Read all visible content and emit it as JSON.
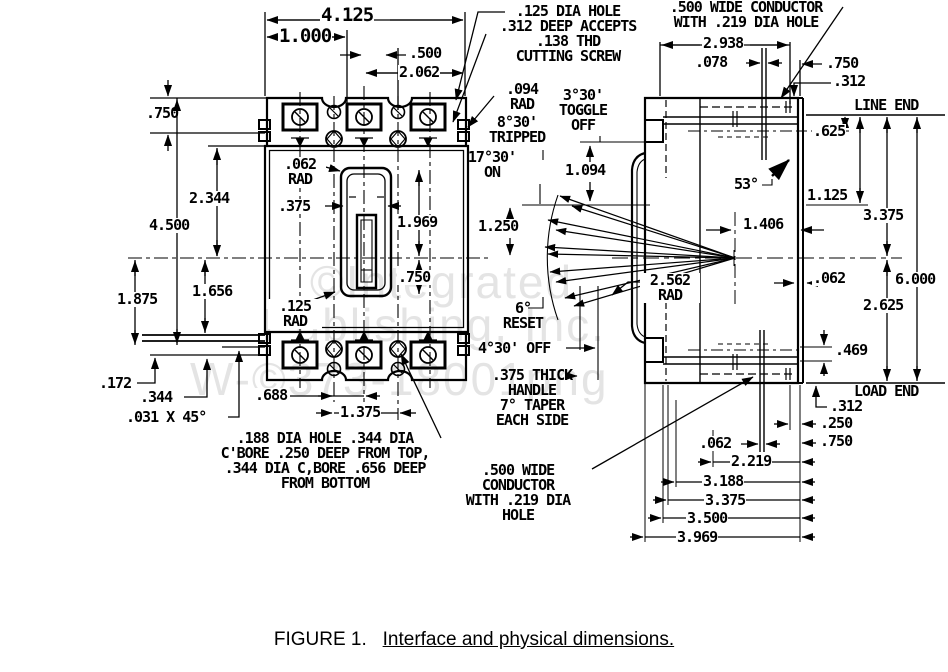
{
  "caption": {
    "figure": "FIGURE 1.",
    "title": "Interface and physical dimensions."
  },
  "watermark": {
    "line1": "©Integrated",
    "line2": "Publishing, Inc.",
    "line3": "W-©373-18001png"
  },
  "front": {
    "d4125": "4.125",
    "d1000": "1.000",
    "d500": ".500",
    "d2062": "2.062",
    "d750t": ".750",
    "d2344": "2.344",
    "d4500": "4.500",
    "d1656": "1.656",
    "d1875": "1.875",
    "r062": ".062\nRAD",
    "d375": ".375",
    "d1969": "1.969",
    "d750m": ".750",
    "r125": ".125\nRAD",
    "d172": ".172",
    "d344": ".344",
    "chamfer": ".031 X 45°",
    "d688": ".688",
    "d1375": "1.375",
    "bore_note": ".188 DIA HOLE .344 DIA\nC'BORE .250 DEEP FROM TOP,\n.344 DIA C,BORE .656 DEEP\nFROM BOTTOM"
  },
  "mid": {
    "screw_note": ".125 DIA HOLE\n.312 DEEP ACCEPTS\n.138 THD\nCUTTING SCREW",
    "r094": ".094\nRAD",
    "tripped": "8°30'\nTRIPPED",
    "on": "17°30'\nON",
    "toggle_off": "3°30'\nTOGGLE\nOFF",
    "d1094": "1.094",
    "d1250": "1.250",
    "reset": "6°\nRESET",
    "off430": "4°30' OFF",
    "handle_note": ".375 THICK\nHANDLE\n7° TAPER\nEACH SIDE",
    "cond_bot": ".500 WIDE\nCONDUCTOR\nWITH .219 DIA\nHOLE",
    "r2562": "2.562\nRAD"
  },
  "side": {
    "cond_top": ".500 WIDE CONDUCTOR\nWITH .219 DIA HOLE",
    "d2938": "2.938",
    "d078": ".078",
    "d750t": ".750",
    "d312t": ".312",
    "line_end": "LINE END",
    "d625": ".625",
    "d1125": "1.125",
    "d3375r": "3.375",
    "d53": "53°",
    "d1406": "1.406",
    "d062r": ".062",
    "d6000": "6.000",
    "d2625": "2.625",
    "d469": ".469",
    "load_end": "LOAD END",
    "d312b": ".312",
    "d250": ".250",
    "d750b": ".750",
    "d062b": ".062",
    "d2219": "2.219",
    "d3188": "3.188",
    "d3375b": "3.375",
    "d3500": "3.500",
    "d3969": "3.969"
  }
}
